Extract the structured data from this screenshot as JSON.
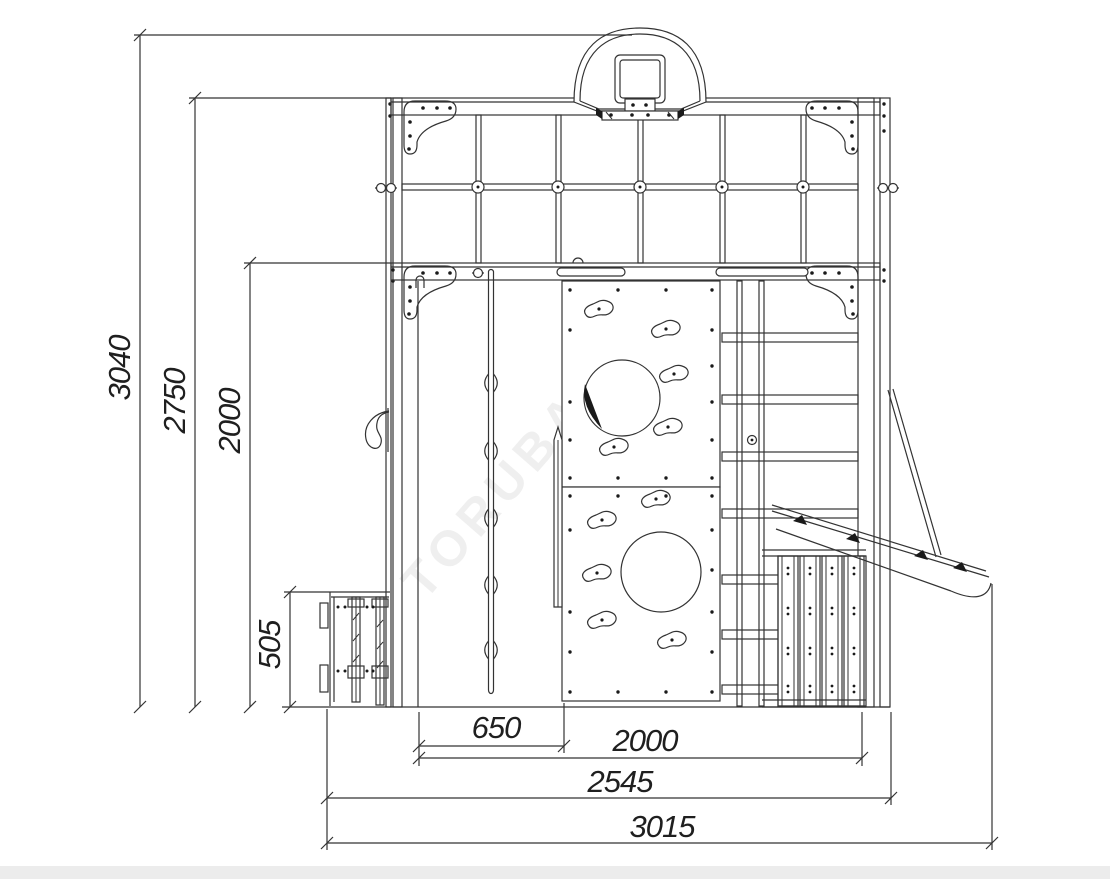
{
  "drawing": {
    "title": "playground-front-elevation",
    "background": "#ffffff",
    "line_color": "#333333",
    "watermark": "TORUBA.RU",
    "vertical_dimensions": [
      {
        "name": "overall-height",
        "value": "3040"
      },
      {
        "name": "frame-height",
        "value": "2750"
      },
      {
        "name": "floor-height",
        "value": "2000"
      },
      {
        "name": "sandbox-height",
        "value": "505"
      }
    ],
    "horizontal_dimensions": [
      {
        "name": "porch-width",
        "value": "650"
      },
      {
        "name": "frame-width",
        "value": "2000"
      },
      {
        "name": "body-width",
        "value": "2545"
      },
      {
        "name": "overall-width",
        "value": "3015"
      }
    ]
  }
}
